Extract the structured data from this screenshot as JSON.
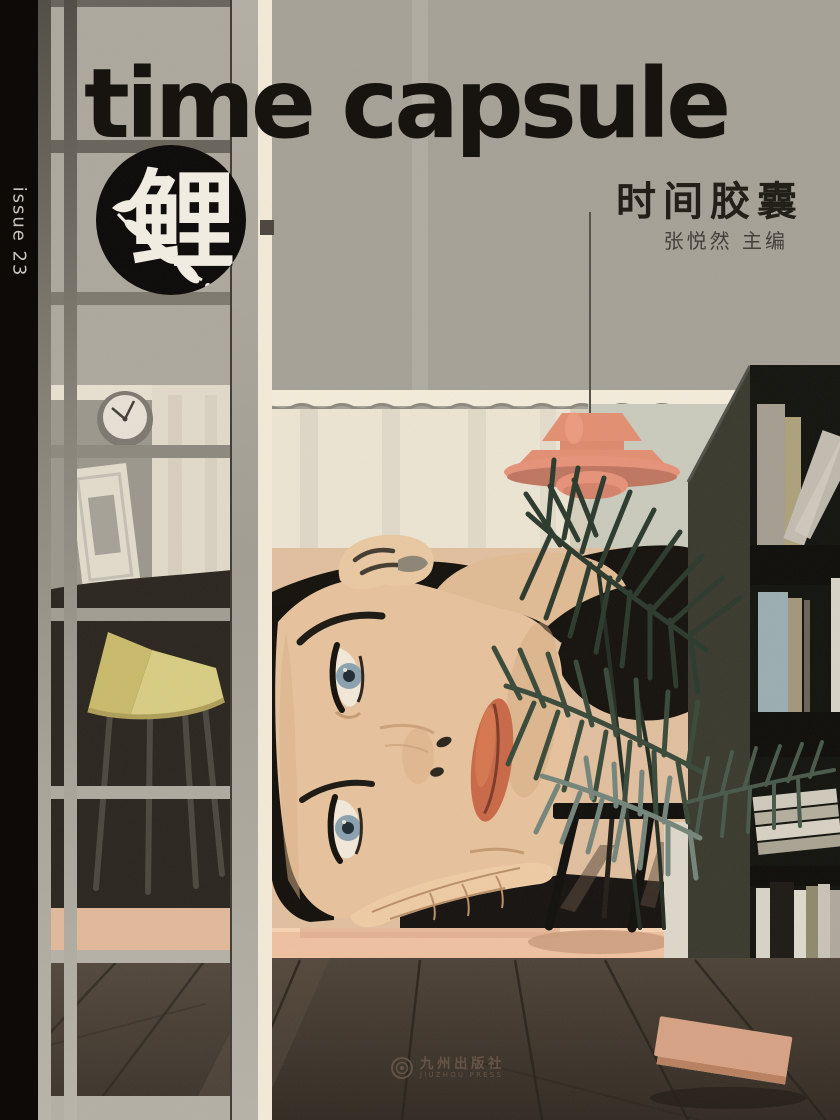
{
  "cover": {
    "spine_label": "issue 23",
    "title": "time capsule",
    "title_cn": "时间胶囊",
    "editor_byline": "张悦然 主编",
    "logo_character": "鲤",
    "publisher": {
      "name_cn": "九州出版社",
      "name_en": "JIUZHOU PRESS"
    }
  },
  "palette": {
    "spine_black": "#0d0a08",
    "ink_black": "#15110c",
    "wall_gray": "#a5a197",
    "curtain_cream": "#ece4d2",
    "lamp_coral": "#e28f72",
    "skin": "#e6c29c",
    "eye_blue": "#8aa2ae",
    "lip_coral": "#c96947",
    "palm_green": "#2c3a2d",
    "chair_yellow": "#d8ca74",
    "mattress_pink": "#edc0a0",
    "floor_brown": "#453b31",
    "shelf_dark": "#14140f",
    "spine_text": "#c9c5bd"
  }
}
